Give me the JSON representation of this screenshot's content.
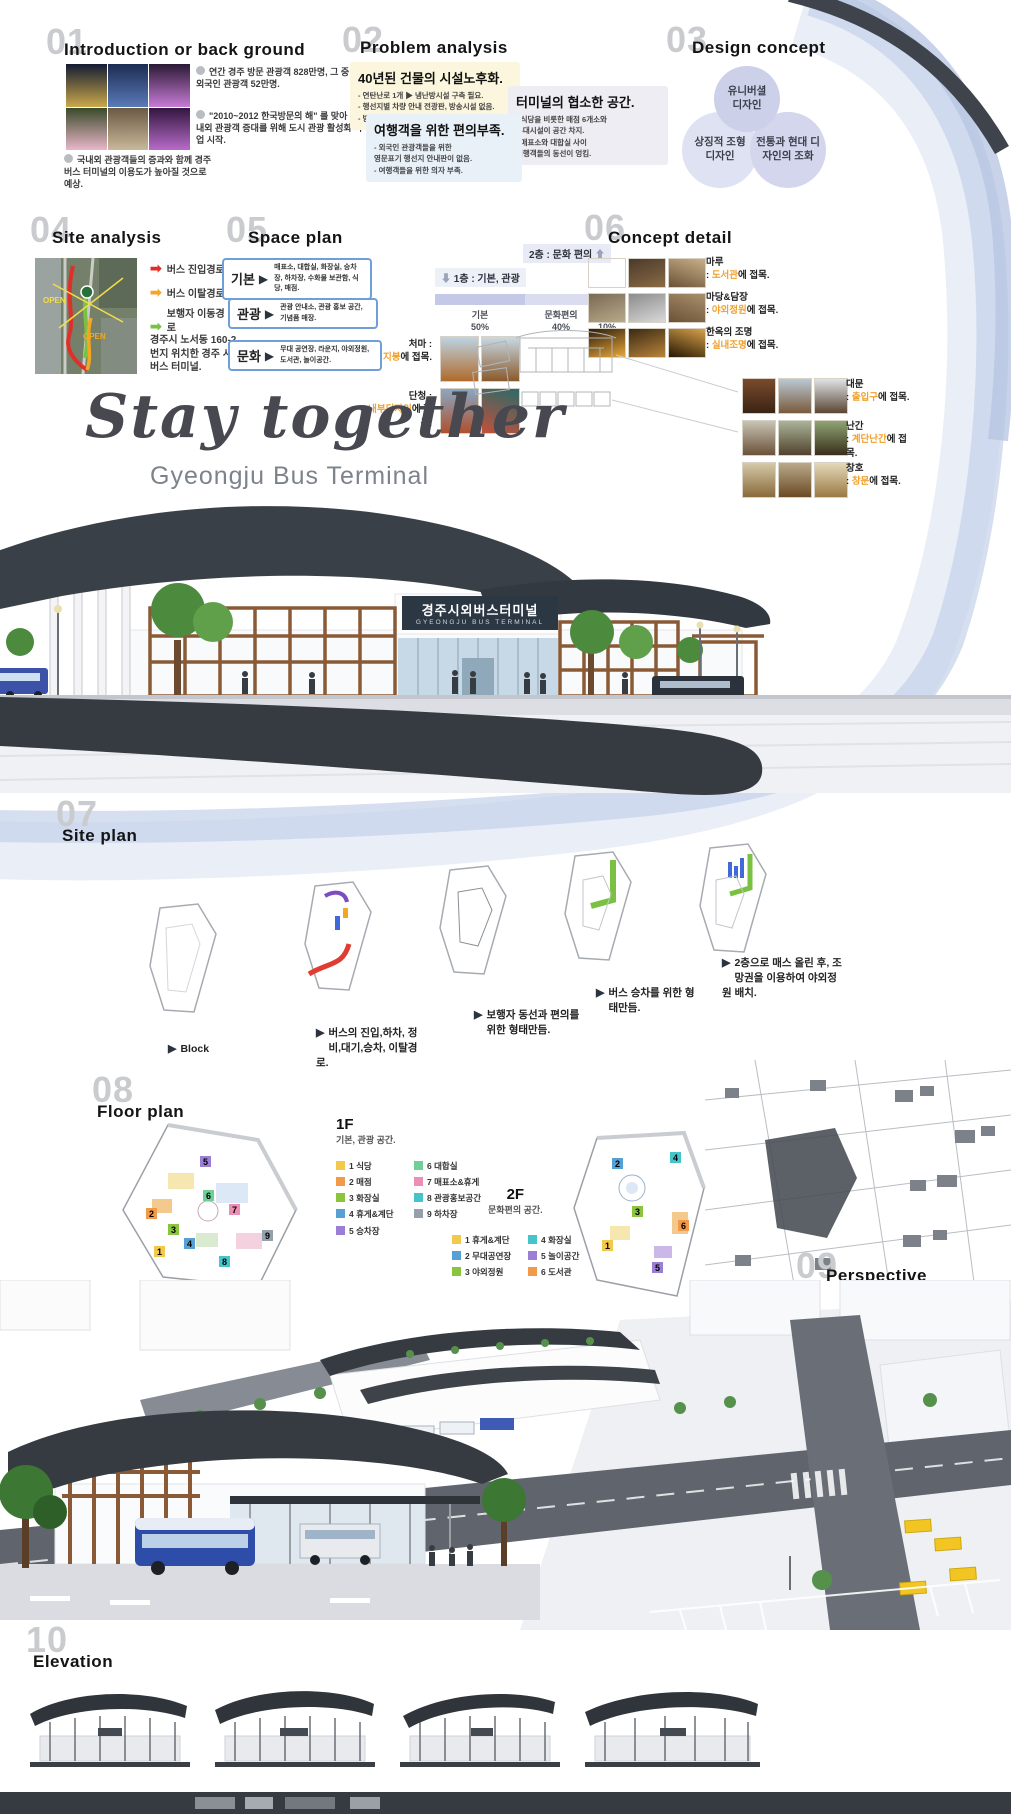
{
  "poster": {
    "title": "Stay together",
    "subtitle": "Gyeongju Bus Terminal",
    "sign_ko": "경주시외버스터미널",
    "sign_en": "GYEONGJU BUS TERMINAL",
    "sep": ": ",
    "accent_orange": "#f0a12f",
    "dark": "#363b42",
    "ribbon_blue": "#c6d1ea"
  },
  "s01": {
    "num": "01",
    "title": "Introduction or back ground",
    "note1": "연간 경주 방문 관광객 828만명, 그 중 외국인 관광객 52만명.",
    "note2": "\"2010~2012 한국방문의 해\" 를 맞아 국내외 관광객 증대를 위해 도시 관광 활성화 사업 시작.",
    "note3": "국내외 관광객들의 증과와 함께 경주 버스 터미널의 이용도가 높아질 것으로 예상."
  },
  "s02": {
    "num": "02",
    "title": "Problem analysis",
    "box1": {
      "title": "40년된 건물의 시설노후화.",
      "bg": "#fbf6dd",
      "lines": [
        "- 연탄난로 1개 ▶ 냉난방시설 구축 필요.",
        "- 행선지별 차량 안내 전광판, 방송시설 없음.",
        "- 방범용 CCTV 없음 ▶ 민생범죄에 취약."
      ]
    },
    "box2": {
      "title": "여행객을 위한 편의부족.",
      "bg": "#e9f1f8",
      "lines": [
        "- 외국인 관광객들을 위한",
        "  영문표기 행선지 안내판이 없음.",
        "- 여행객들을 위한 의자 부족."
      ]
    },
    "box3": {
      "title": "터미널의 협소한 공간.",
      "bg": "#ededf3",
      "lines": [
        "- 식당을 비롯한 매점 6개소와",
        "  부대시설이 공간 차지.",
        "- 매표소와 대합실 사이",
        "  여행객들의 동선이 엉킴."
      ]
    }
  },
  "s03": {
    "num": "03",
    "title": "Design concept",
    "circle1": "유니버셜 디자인",
    "circle2": "상징적 조형 디자인",
    "circle3": "전통과 현대 디자인의 조화"
  },
  "s04": {
    "num": "04",
    "title": "Site analysis",
    "legend": [
      {
        "label": "버스 진입경로",
        "color": "#e02f28"
      },
      {
        "label": "버스 이탈경로",
        "color": "#f5a623"
      },
      {
        "label": "보행자 이동경로",
        "color": "#7ac143"
      }
    ],
    "map_labels": [
      "OPEN",
      "OPEN"
    ],
    "caption": "경주시 노서동 160-2번지 위치한 경주 시외버스 터미널."
  },
  "s05": {
    "num": "05",
    "title": "Space plan",
    "rows": [
      {
        "key": "기본",
        "desc": "매표소, 대합실, 화장실, 승차장, 하차장, 수화물 보관함, 식당, 매점."
      },
      {
        "key": "관광",
        "desc": "관광 안내소, 관광 홍보 공간, 기념품 매장."
      },
      {
        "key": "문화",
        "desc": "무대 공연장, 라운지, 야외정원, 도서관, 놀이공간."
      }
    ],
    "chart": {
      "floor1": "1층 : 기본, 관광",
      "floor2": "2층 : 문화 편의",
      "segments": [
        {
          "label": "기본",
          "pct": "50%",
          "value": 50,
          "color": "#c3c9e6"
        },
        {
          "label": "문화편의",
          "pct": "40%",
          "value": 40,
          "color": "#d9ddef"
        },
        {
          "label": "관광",
          "pct": "10%",
          "value": 10,
          "color": "#eceef7"
        }
      ]
    }
  },
  "chart_data": {
    "type": "bar",
    "categories": [
      "기본",
      "문화편의",
      "관광"
    ],
    "values": [
      50,
      40,
      10
    ],
    "title": "",
    "xlabel": "",
    "ylabel": "",
    "annotations": [
      "1층 : 기본, 관광",
      "2층 : 문화 편의"
    ],
    "orientation": "horizontal-stacked"
  },
  "s06": {
    "num": "06",
    "title": "Concept detail",
    "items": [
      {
        "name": "마루",
        "target": "도서관",
        "tail": "에 접목."
      },
      {
        "name": "마당&담장",
        "target": "야외정원",
        "tail": "에 접목."
      },
      {
        "name": "한옥의 조명",
        "target": "실내조명",
        "tail": "에 접목."
      },
      {
        "name": "처마",
        "target": "지붕",
        "tail": "에 접목."
      },
      {
        "name": "단청",
        "target": "내부디자인",
        "tail": "에 접목."
      },
      {
        "name": "대문",
        "target": "출입구",
        "tail": "에 접목."
      },
      {
        "name": "난간",
        "target": "계단난간",
        "tail": "에 접목."
      },
      {
        "name": "창호",
        "target": "창문",
        "tail": "에 접목."
      }
    ]
  },
  "s07": {
    "num": "07",
    "title": "Site plan",
    "steps": [
      {
        "label": "Block"
      },
      {
        "label": "버스의 진입,하차, 정비,대기,승차, 이탈경로."
      },
      {
        "label": "보행자 동선과 편의를 위한 형태만듬."
      },
      {
        "label": "버스 승차를 위한 형태만듬."
      },
      {
        "label": "2층으로 매스 올린 후, 조망권을 이용하여 야외정원 배치."
      }
    ]
  },
  "s08": {
    "num": "08",
    "title": "Floor plan",
    "f1": {
      "name": "1F",
      "sub": "기본, 관광 공간.",
      "items": [
        {
          "n": "1",
          "label": "식당",
          "color": "#f2c94c"
        },
        {
          "n": "2",
          "label": "매점",
          "color": "#f2994a"
        },
        {
          "n": "3",
          "label": "화장실",
          "color": "#8bc53f"
        },
        {
          "n": "4",
          "label": "휴게&계단",
          "color": "#56a0d3"
        },
        {
          "n": "5",
          "label": "승차장",
          "color": "#9b7fd4"
        },
        {
          "n": "6",
          "label": "대합실",
          "color": "#6fcf97"
        },
        {
          "n": "7",
          "label": "매표소&휴게",
          "color": "#eb8fb5"
        },
        {
          "n": "8",
          "label": "관광홍보공간",
          "color": "#45c4c9"
        },
        {
          "n": "9",
          "label": "하차장",
          "color": "#95a0ab"
        }
      ]
    },
    "f2": {
      "name": "2F",
      "sub": "문화편의 공간.",
      "items": [
        {
          "n": "1",
          "label": "휴게&계단",
          "color": "#f2c94c"
        },
        {
          "n": "2",
          "label": "무대공연장",
          "color": "#56a0d3"
        },
        {
          "n": "3",
          "label": "야외정원",
          "color": "#8bc53f"
        },
        {
          "n": "4",
          "label": "화장실",
          "color": "#45c4c9"
        },
        {
          "n": "5",
          "label": "놀이공간",
          "color": "#9b7fd4"
        },
        {
          "n": "6",
          "label": "도서관",
          "color": "#f2994a"
        }
      ]
    }
  },
  "s09": {
    "num": "09",
    "title": "Perspective"
  },
  "s10": {
    "num": "10",
    "title": "Elevation"
  }
}
